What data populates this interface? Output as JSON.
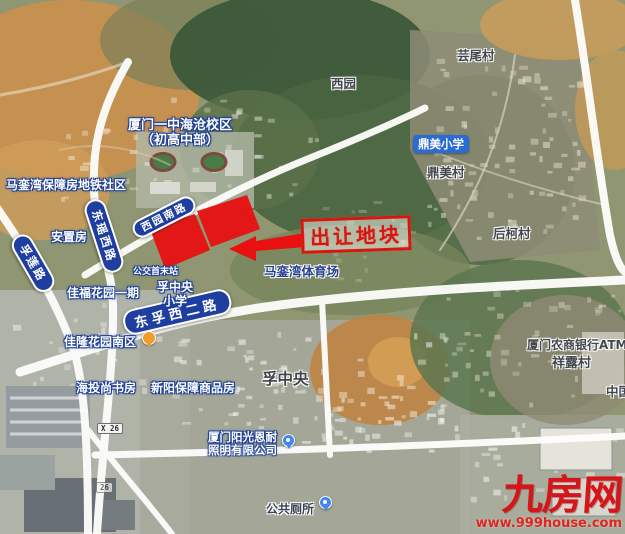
{
  "annotation": {
    "callout": "出让地块"
  },
  "roads": {
    "fulian": "孚莲路",
    "dongyao_west": "东瑶西路",
    "xiyuan_south": "西园南路",
    "dongfu_west2": "东孚西二路",
    "x26_badge": "X 26",
    "x26_badge_faded": "26"
  },
  "places": {
    "school_campus_line1": "厦门一中海沧校区",
    "school_campus_line2": "（初高中部）",
    "metro_community": "马銮湾保障房地铁社区",
    "resettlement_housing": "安置房",
    "bus_terminus": "公交首末站",
    "jiafu_garden": "佳福花园一期",
    "fuzhongyang_primary_line1": "孚中央",
    "fuzhongyang_primary_line2": "小学",
    "jialong_garden": "佳隆花园南区",
    "haitou_bookstore": "海投尚书房",
    "xinyang_housing": "新阳保障商品房",
    "fuzhongyang_area": "孚中央",
    "maluanwan_stadium": "马銮湾体育场",
    "lighting_co_line1": "厦门阳光恩耐",
    "lighting_co_line2": "照明有限公司",
    "public_toilet": "公共厕所",
    "xiyuan": "西园",
    "yunwei_village": "芸尾村",
    "dingmei_primary": "鼎美小学",
    "dingmei_village": "鼎美村",
    "houke_village": "后柯村",
    "rural_bank_atm": "厦门农商银行ATM",
    "xianglu_village": "祥露村",
    "china_partial": "中国"
  },
  "watermark": {
    "logo": "九房网",
    "url": "www.999house.com"
  },
  "icons": {
    "orange_poi_pin": "orange-map-pin",
    "blue_poi_pin_lighting": "blue-map-pin",
    "blue_poi_pin_south": "blue-map-pin"
  },
  "colors": {
    "plot_red": "#e81010",
    "callout_red": "#d9150f",
    "ribbon_blue": "#1e3f9f",
    "school_pill_blue": "#2b6bd4",
    "watermark_red": "#d4161b",
    "road_white": "#fdfdfb"
  }
}
